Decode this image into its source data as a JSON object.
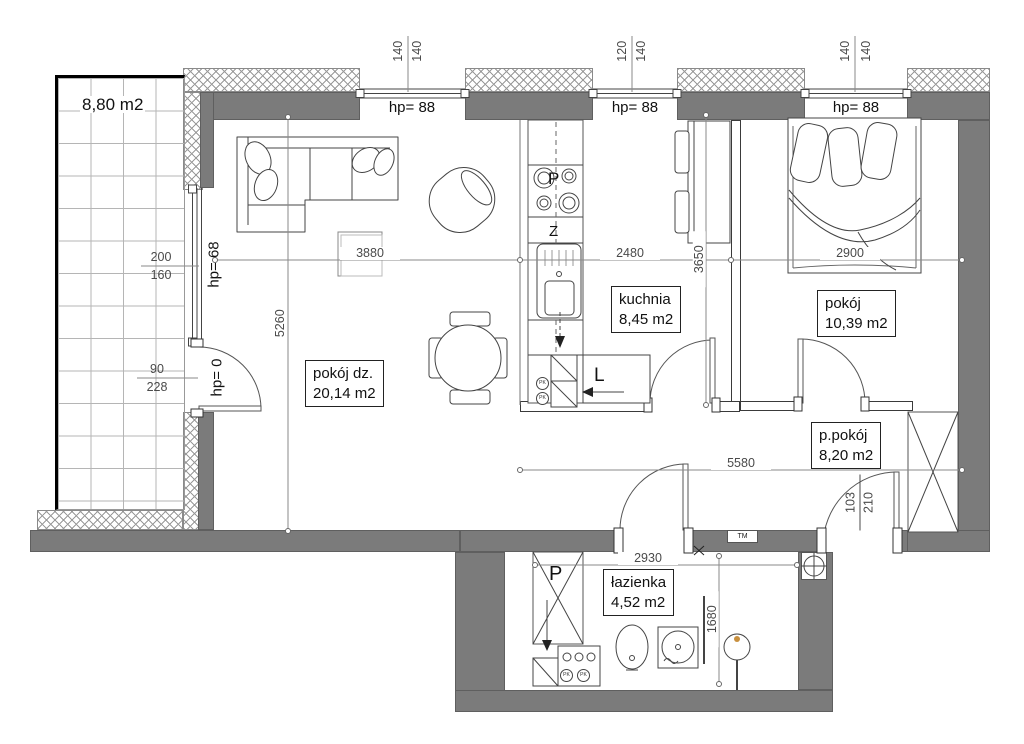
{
  "rooms": {
    "balcony": {
      "area": "8,80 m2"
    },
    "living": {
      "name": "pokój dz.",
      "area": "20,14 m2"
    },
    "kitchen": {
      "name": "kuchnia",
      "area": "8,45 m2"
    },
    "bedroom": {
      "name": "pokój",
      "area": "10,39 m2"
    },
    "hallway": {
      "name": "p.pokój",
      "area": "8,20 m2"
    },
    "bathroom": {
      "name": "łazienka",
      "area": "4,52 m2"
    }
  },
  "openings": {
    "window1": {
      "sill": "hp= 88",
      "width": "140",
      "height": "140"
    },
    "window2": {
      "sill": "hp= 88",
      "width": "120",
      "height": "140"
    },
    "window3": {
      "sill": "hp= 88",
      "width": "140",
      "height": "140"
    },
    "balcony_window": {
      "sill": "hp= 68",
      "width": "200",
      "height": "160"
    },
    "balcony_door": {
      "sill": "hp= 0",
      "width": "90",
      "height": "228"
    },
    "entrance_door": {
      "width": "103",
      "height": "210"
    }
  },
  "dims": {
    "living_width": "3880",
    "living_depth": "5260",
    "kitchen_width": "2480",
    "kitchen_depth": "3650",
    "bedroom_width": "2900",
    "hallway_width": "5580",
    "bathroom_width": "2930",
    "bathroom_depth": "1680"
  },
  "symbols": {
    "stove": "P",
    "sink": "Z",
    "fridge": "L",
    "shower": "P",
    "vent": "PK",
    "meter": "TM"
  }
}
